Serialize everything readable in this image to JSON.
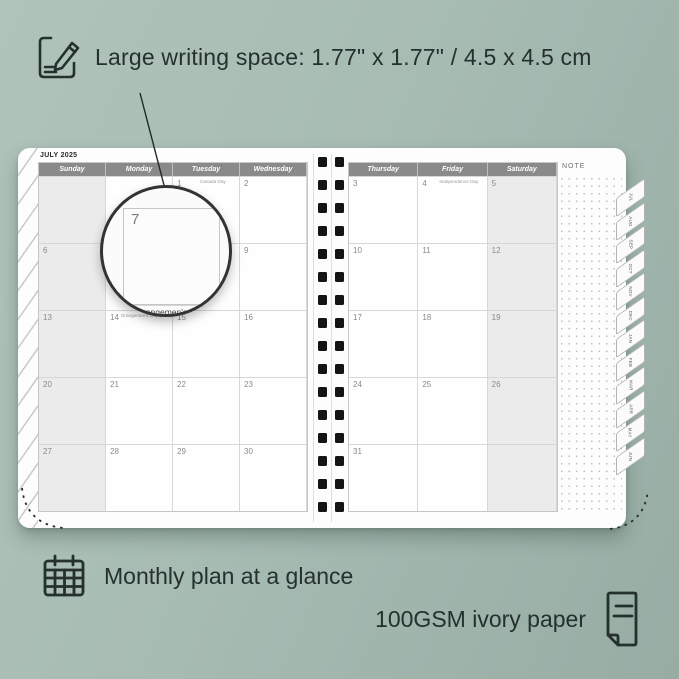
{
  "colors": {
    "background_left": "#b0c3ba",
    "background_right": "#97ada4",
    "ink": "#24312d",
    "header_bar": "#8a8a8a",
    "weekend_fill": "#ebebeb",
    "grid_line": "#d7d7d7",
    "binding_hole": "#141414"
  },
  "annotations": {
    "top": {
      "icon": "note-pencil-icon",
      "text": "Large writing space: 1.77\" x 1.77\" / 4.5 x 4.5 cm"
    },
    "bottom_left": {
      "icon": "calendar-grid-icon",
      "text": "Monthly plan at a glance"
    },
    "bottom_right": {
      "icon": "paper-sheet-icon",
      "text": "100GSM ivory paper"
    }
  },
  "planner": {
    "month_title": "JULY 2025",
    "note_label": "NOTE",
    "left_day_headers": [
      "Sunday",
      "Monday",
      "Tuesday",
      "Wednesday"
    ],
    "right_day_headers": [
      "Thursday",
      "Friday",
      "Saturday"
    ],
    "left_weeks": [
      [
        {
          "day": ""
        },
        {
          "day": ""
        },
        {
          "day": "1",
          "holiday": "Canada Day"
        },
        {
          "day": "2"
        }
      ],
      [
        {
          "day": "6"
        },
        {
          "day": "7"
        },
        {
          "day": "8"
        },
        {
          "day": "9"
        }
      ],
      [
        {
          "day": "13"
        },
        {
          "day": "14",
          "holiday": "Orangemen's Day (N.L.)"
        },
        {
          "day": "15"
        },
        {
          "day": "16"
        }
      ],
      [
        {
          "day": "20"
        },
        {
          "day": "21"
        },
        {
          "day": "22"
        },
        {
          "day": "23"
        }
      ],
      [
        {
          "day": "27"
        },
        {
          "day": "28"
        },
        {
          "day": "29"
        },
        {
          "day": "30"
        }
      ]
    ],
    "right_weeks": [
      [
        {
          "day": "3"
        },
        {
          "day": "4",
          "holiday": "Independence Day"
        },
        {
          "day": "5"
        }
      ],
      [
        {
          "day": "10"
        },
        {
          "day": "11"
        },
        {
          "day": "12"
        }
      ],
      [
        {
          "day": "17"
        },
        {
          "day": "18"
        },
        {
          "day": "19"
        }
      ],
      [
        {
          "day": "24"
        },
        {
          "day": "25"
        },
        {
          "day": "26"
        }
      ],
      [
        {
          "day": "31"
        },
        {
          "day": ""
        },
        {
          "day": ""
        }
      ]
    ],
    "month_tabs": [
      "JUL",
      "AUG",
      "SEP",
      "OCT",
      "NOV",
      "DEC",
      "JAN",
      "FEB",
      "MAR",
      "APR",
      "MAY",
      "JUN"
    ],
    "magnifier": {
      "day": "7",
      "caption": "Orangemen's D"
    }
  }
}
